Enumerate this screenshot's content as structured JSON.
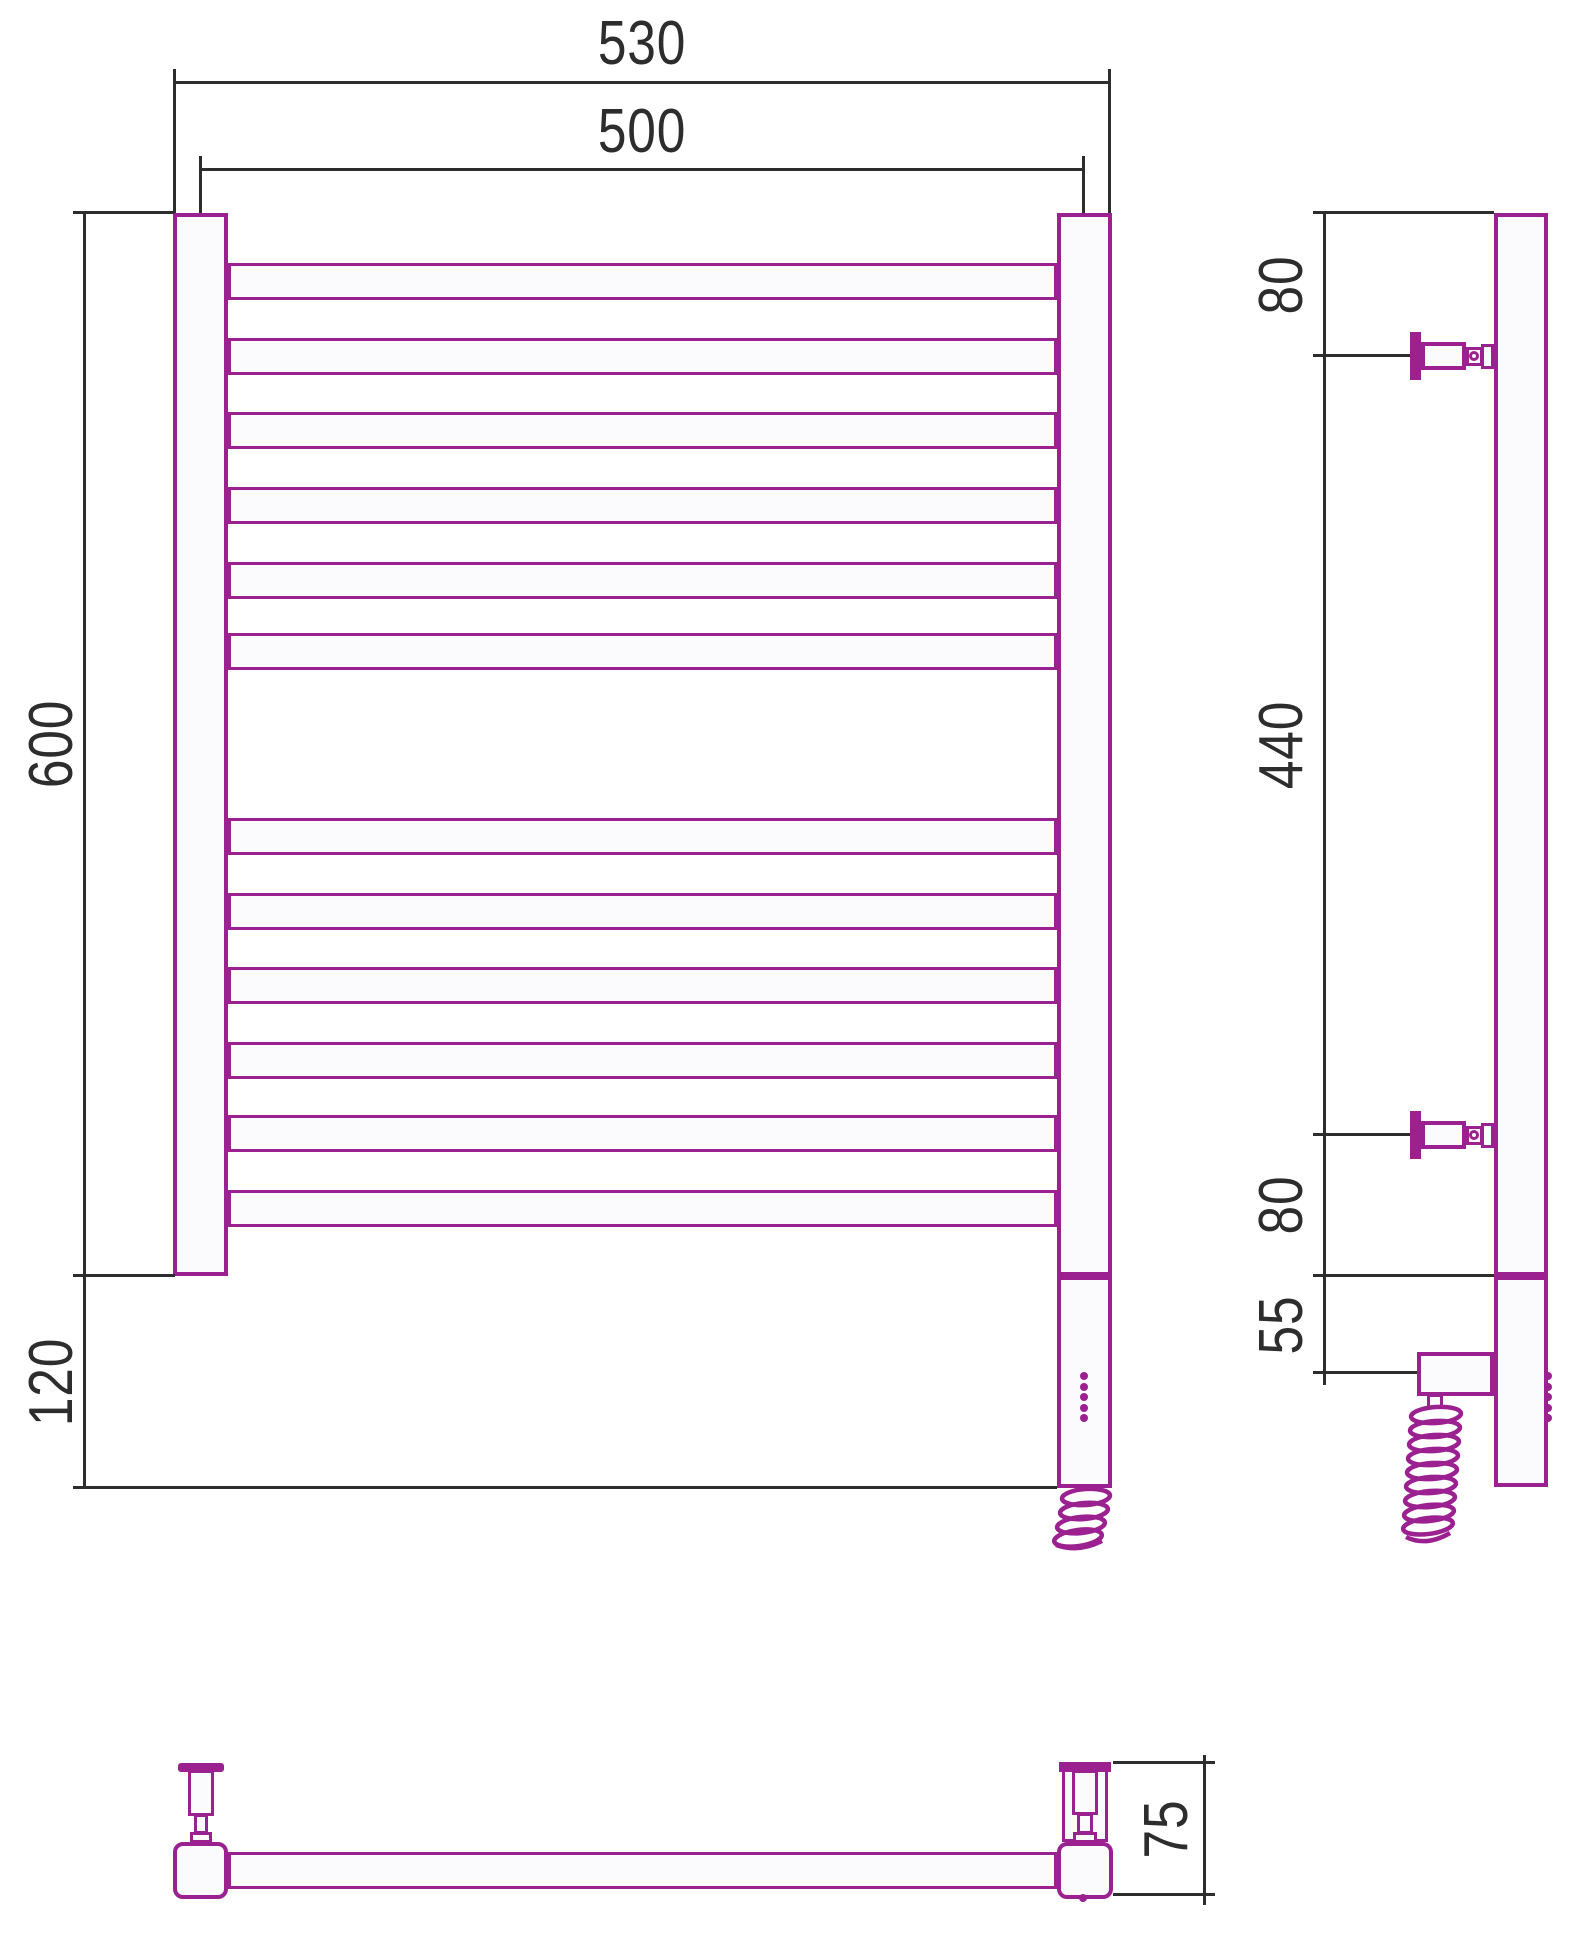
{
  "colors": {
    "line": "#9C2190",
    "dimension": "#2D2D2D",
    "fill": "#FBFAFC"
  },
  "front": {
    "dim_outer_width": "530",
    "dim_center_width": "500",
    "dim_height": "600",
    "dim_bottom_offset": "120",
    "rungs": {
      "count": 12,
      "tops": [
        263,
        338,
        412,
        487,
        562,
        633,
        818,
        893,
        967,
        1042,
        1115,
        1190
      ]
    },
    "led_count": 5
  },
  "side": {
    "dim_top_offset": "80",
    "dim_bracket_span": "440",
    "dim_lower_offset": "80",
    "dim_element_offset": "55",
    "led_count": 5
  },
  "bottom": {
    "dim_depth": "75"
  }
}
